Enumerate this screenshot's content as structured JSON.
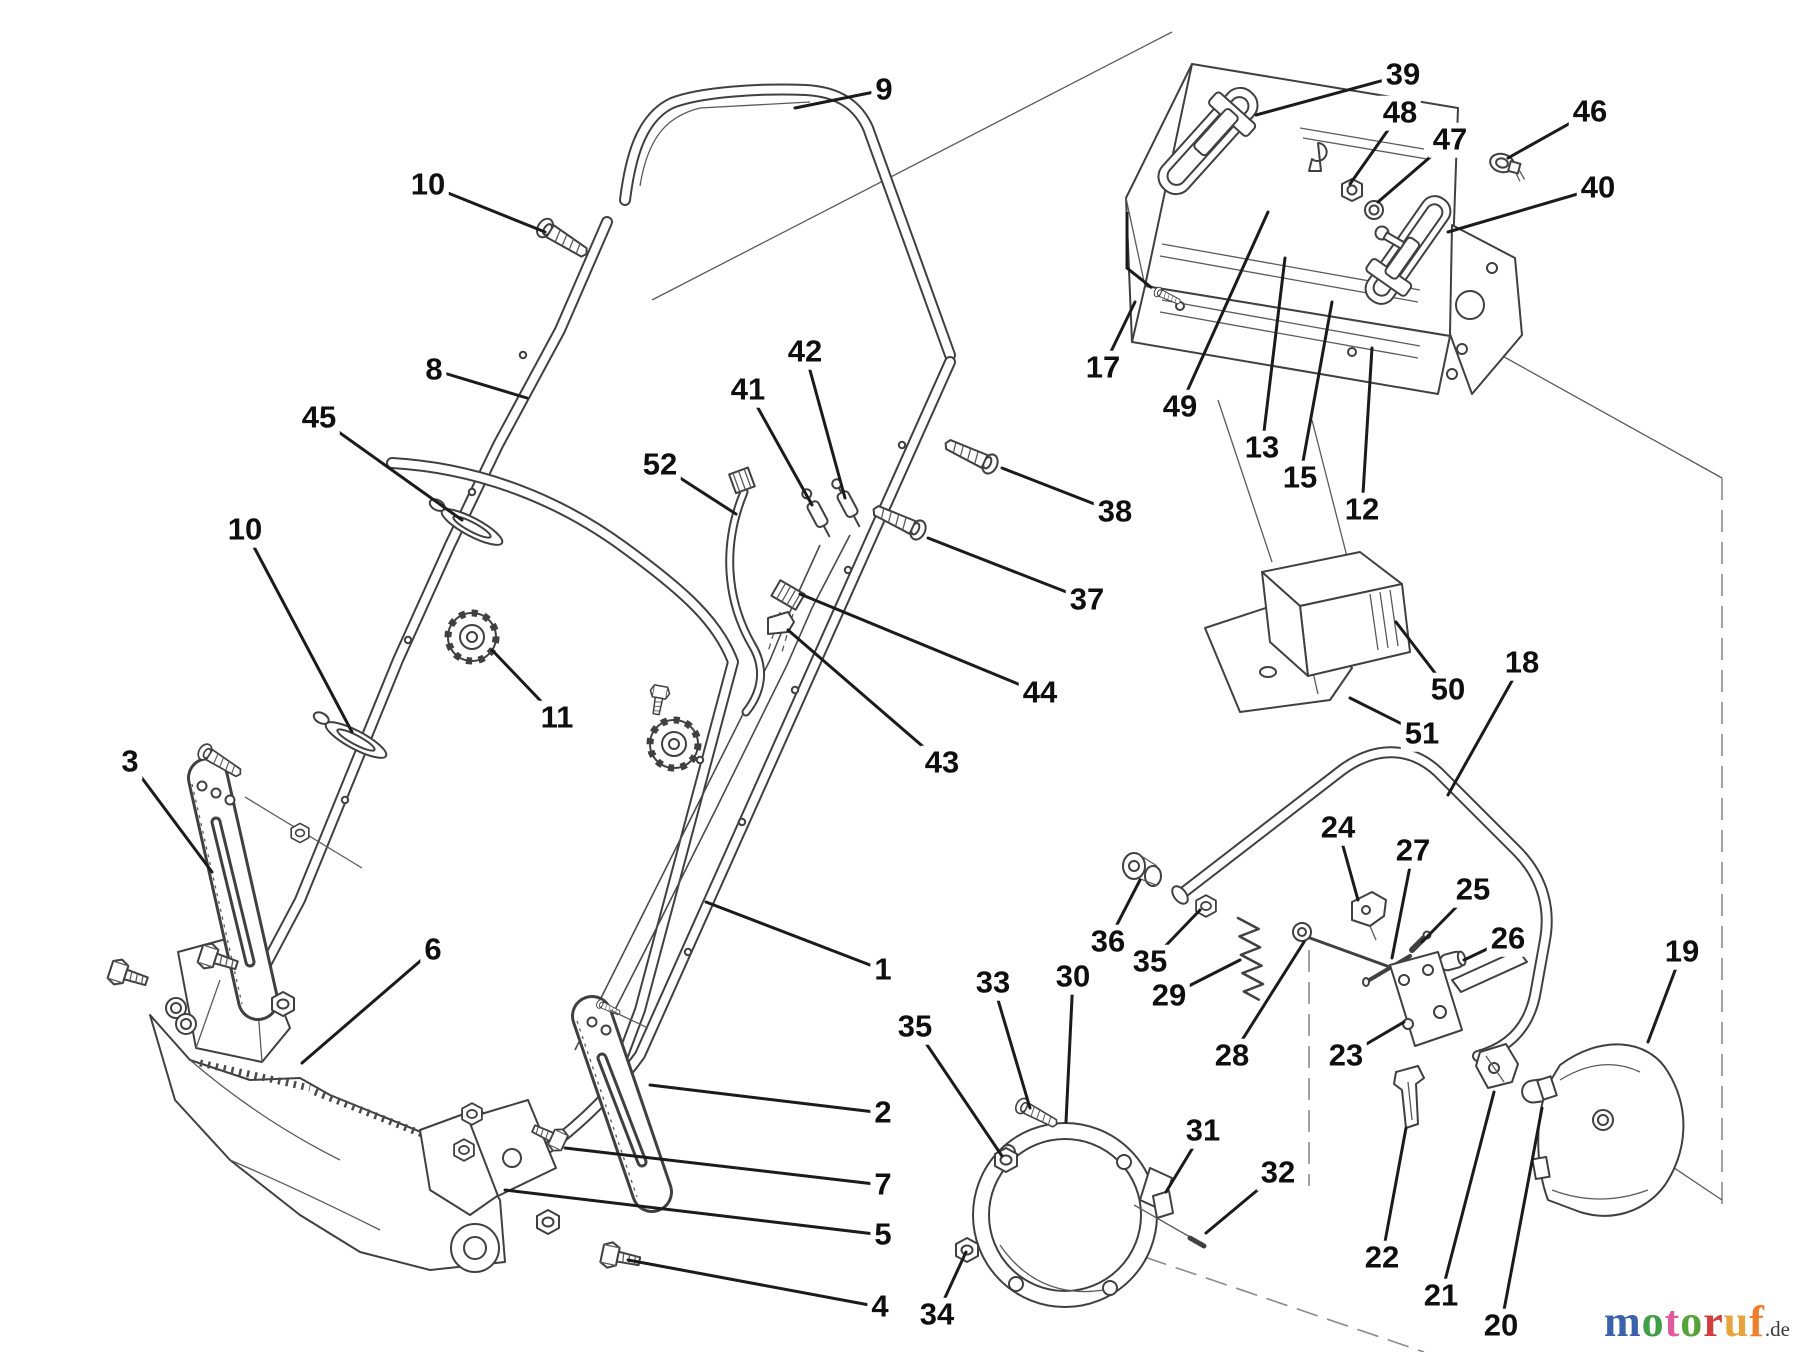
{
  "diagram": {
    "kind": "exploded-parts-diagram",
    "background": "#ffffff",
    "line_color": "#404040",
    "leader_color": "#1b1b1b"
  },
  "logo": {
    "suffix": ".de",
    "letters": [
      {
        "ch": "m",
        "color": "#3b62ac"
      },
      {
        "ch": "o",
        "color": "#3f9f47"
      },
      {
        "ch": "t",
        "color": "#e05a9e"
      },
      {
        "ch": "o",
        "color": "#58a23a"
      },
      {
        "ch": "r",
        "color": "#d43d3d"
      },
      {
        "ch": "u",
        "color": "#e8a33c"
      },
      {
        "ch": "f",
        "color": "#ee7f2f"
      }
    ]
  },
  "callouts": [
    {
      "n": "1",
      "x": 883,
      "y": 970,
      "tx": 706,
      "ty": 902
    },
    {
      "n": "2",
      "x": 883,
      "y": 1113,
      "tx": 650,
      "ty": 1085
    },
    {
      "n": "3",
      "x": 130,
      "y": 762,
      "tx": 212,
      "ty": 872
    },
    {
      "n": "4",
      "x": 880,
      "y": 1307,
      "tx": 628,
      "ty": 1260
    },
    {
      "n": "5",
      "x": 883,
      "y": 1235,
      "tx": 505,
      "ty": 1190
    },
    {
      "n": "6",
      "x": 433,
      "y": 950,
      "tx": 302,
      "ty": 1063
    },
    {
      "n": "7",
      "x": 883,
      "y": 1185,
      "tx": 565,
      "ty": 1148
    },
    {
      "n": "8",
      "x": 434,
      "y": 370,
      "tx": 527,
      "ty": 398
    },
    {
      "n": "9",
      "x": 884,
      "y": 90,
      "tx": 795,
      "ty": 108
    },
    {
      "n": "10",
      "x": 428,
      "y": 185,
      "tx": 545,
      "ty": 232
    },
    {
      "n": "10",
      "x": 245,
      "y": 530,
      "tx": 352,
      "ty": 732
    },
    {
      "n": "11",
      "x": 557,
      "y": 718,
      "tx": 492,
      "ty": 650
    },
    {
      "n": "12",
      "x": 1362,
      "y": 510,
      "tx": 1372,
      "ty": 348
    },
    {
      "n": "13",
      "x": 1262,
      "y": 448,
      "tx": 1285,
      "ty": 258
    },
    {
      "n": "15",
      "x": 1300,
      "y": 478,
      "tx": 1332,
      "ty": 302
    },
    {
      "n": "17",
      "x": 1103,
      "y": 368,
      "tx": 1135,
      "ty": 302
    },
    {
      "n": "18",
      "x": 1522,
      "y": 663,
      "tx": 1448,
      "ty": 795
    },
    {
      "n": "19",
      "x": 1682,
      "y": 952,
      "tx": 1648,
      "ty": 1042
    },
    {
      "n": "20",
      "x": 1501,
      "y": 1326,
      "tx": 1542,
      "ty": 1108
    },
    {
      "n": "21",
      "x": 1441,
      "y": 1296,
      "tx": 1494,
      "ty": 1092
    },
    {
      "n": "22",
      "x": 1382,
      "y": 1258,
      "tx": 1406,
      "ty": 1128
    },
    {
      "n": "23",
      "x": 1346,
      "y": 1056,
      "tx": 1404,
      "ty": 1022
    },
    {
      "n": "24",
      "x": 1338,
      "y": 828,
      "tx": 1358,
      "ty": 900
    },
    {
      "n": "25",
      "x": 1473,
      "y": 890,
      "tx": 1422,
      "ty": 942
    },
    {
      "n": "26",
      "x": 1508,
      "y": 939,
      "tx": 1464,
      "ty": 960
    },
    {
      "n": "27",
      "x": 1413,
      "y": 851,
      "tx": 1392,
      "ty": 958
    },
    {
      "n": "28",
      "x": 1232,
      "y": 1056,
      "tx": 1304,
      "ty": 942
    },
    {
      "n": "29",
      "x": 1169,
      "y": 996,
      "tx": 1240,
      "ty": 960
    },
    {
      "n": "30",
      "x": 1073,
      "y": 977,
      "tx": 1066,
      "ty": 1122
    },
    {
      "n": "31",
      "x": 1203,
      "y": 1131,
      "tx": 1166,
      "ty": 1192
    },
    {
      "n": "32",
      "x": 1278,
      "y": 1173,
      "tx": 1206,
      "ty": 1233
    },
    {
      "n": "33",
      "x": 993,
      "y": 983,
      "tx": 1030,
      "ty": 1108
    },
    {
      "n": "34",
      "x": 937,
      "y": 1315,
      "tx": 966,
      "ty": 1252
    },
    {
      "n": "35",
      "x": 915,
      "y": 1027,
      "tx": 1002,
      "ty": 1156
    },
    {
      "n": "35",
      "x": 1150,
      "y": 962,
      "tx": 1200,
      "ty": 910
    },
    {
      "n": "36",
      "x": 1108,
      "y": 942,
      "tx": 1140,
      "ty": 880
    },
    {
      "n": "37",
      "x": 1087,
      "y": 600,
      "tx": 928,
      "ty": 538
    },
    {
      "n": "38",
      "x": 1115,
      "y": 512,
      "tx": 1002,
      "ty": 468
    },
    {
      "n": "39",
      "x": 1403,
      "y": 75,
      "tx": 1256,
      "ty": 115
    },
    {
      "n": "40",
      "x": 1598,
      "y": 188,
      "tx": 1448,
      "ty": 232
    },
    {
      "n": "41",
      "x": 748,
      "y": 390,
      "tx": 812,
      "ty": 505
    },
    {
      "n": "42",
      "x": 805,
      "y": 352,
      "tx": 845,
      "ty": 498
    },
    {
      "n": "43",
      "x": 942,
      "y": 763,
      "tx": 788,
      "ty": 630
    },
    {
      "n": "44",
      "x": 1040,
      "y": 693,
      "tx": 800,
      "ty": 594
    },
    {
      "n": "45",
      "x": 319,
      "y": 418,
      "tx": 462,
      "ty": 520
    },
    {
      "n": "46",
      "x": 1590,
      "y": 112,
      "tx": 1508,
      "ty": 158
    },
    {
      "n": "47",
      "x": 1450,
      "y": 140,
      "tx": 1378,
      "ty": 202
    },
    {
      "n": "48",
      "x": 1400,
      "y": 113,
      "tx": 1350,
      "ty": 184
    },
    {
      "n": "49",
      "x": 1180,
      "y": 407,
      "tx": 1268,
      "ty": 212
    },
    {
      "n": "50",
      "x": 1448,
      "y": 690,
      "tx": 1396,
      "ty": 622
    },
    {
      "n": "51",
      "x": 1422,
      "y": 734,
      "tx": 1350,
      "ty": 698
    },
    {
      "n": "52",
      "x": 660,
      "y": 465,
      "tx": 736,
      "ty": 514
    }
  ]
}
